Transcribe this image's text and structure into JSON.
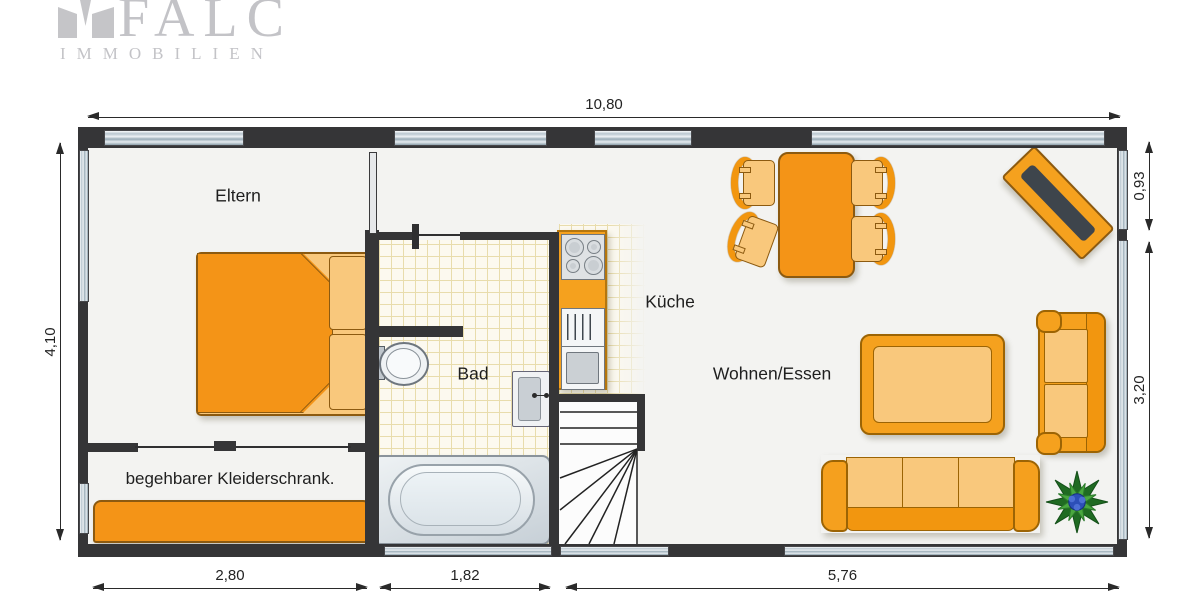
{
  "logo": {
    "brand": "FALC",
    "subtitle": "IMMOBILIEN"
  },
  "rooms": {
    "eltern": "Eltern",
    "bad": "Bad",
    "kueche": "Küche",
    "wohnen": "Wohnen/Essen",
    "closet": "begehbarer Kleiderschrank."
  },
  "dimensions": {
    "top": "10,80",
    "left": "4,10",
    "right_top": "0,93",
    "right_bottom": "3,20",
    "bottom_left": "2,80",
    "bottom_mid": "1,82",
    "bottom_right": "5,76"
  },
  "colors": {
    "furniture_orange": "#f49417",
    "furniture_light": "#f9c87c",
    "wall_dark": "#353537",
    "window_blue": "#b9c6cf",
    "tile_line": "#e8dcac",
    "plant_green": "#2e8b2e",
    "plant_blue": "#2c4fb8",
    "logo_gray": "#c3c3c7"
  }
}
